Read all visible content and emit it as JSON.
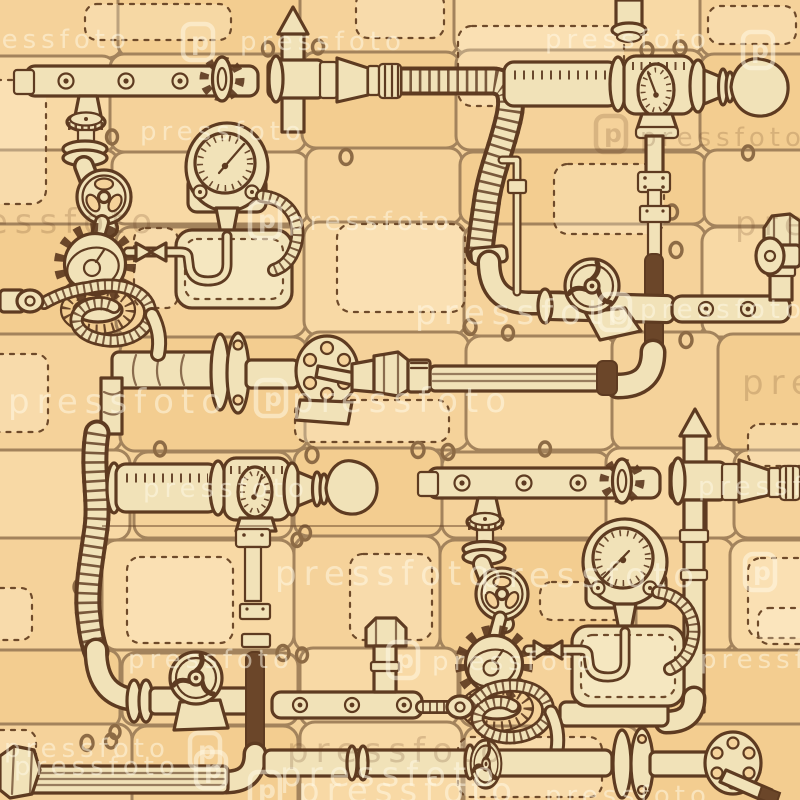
{
  "image": {
    "title": "Seamless steampunk pipes pattern",
    "style": "hand-drawn vintage sketch illustration",
    "subject": "pipes, valves, pressure gauges, gears, corrugated hoses and stitched patch boxes on riveted metal plates"
  },
  "watermark": {
    "text": "pressfoto",
    "logo_letter": "p"
  },
  "palette": {
    "background": "#f5d29a",
    "plate_fill_dark": "#f3cd90",
    "plate_fill_light": "#f8d9a5",
    "plate_outline": "#a3835c",
    "ink": "#5e3b21",
    "pipe_cream": "#f1e2b8",
    "pipe_dark": "#6b4629",
    "watermark_light": "rgba(255,249,230,0.52)",
    "watermark_dark": "rgba(100,62,28,0.2)"
  },
  "components": [
    "riveted-pipe-bar",
    "gear-knob-valve",
    "spear-top-pipe-tee",
    "stepped-couplings",
    "corrugated-hose",
    "drum-pipe",
    "drum-gauge",
    "bulb-end",
    "pressure-gauge",
    "stitched-patch-box",
    "bowtie-connector",
    "c-hose",
    "three-hole-handwheel",
    "knurled-stem",
    "flange-disc",
    "large-gear",
    "turbine-ring",
    "spiral-hose-coil",
    "pipe-link",
    "perforated-flange-lever",
    "hex-coupling",
    "dark-pipe-segment",
    "three-spoke-handwheel",
    "metal-plate-panels",
    "rivets"
  ]
}
